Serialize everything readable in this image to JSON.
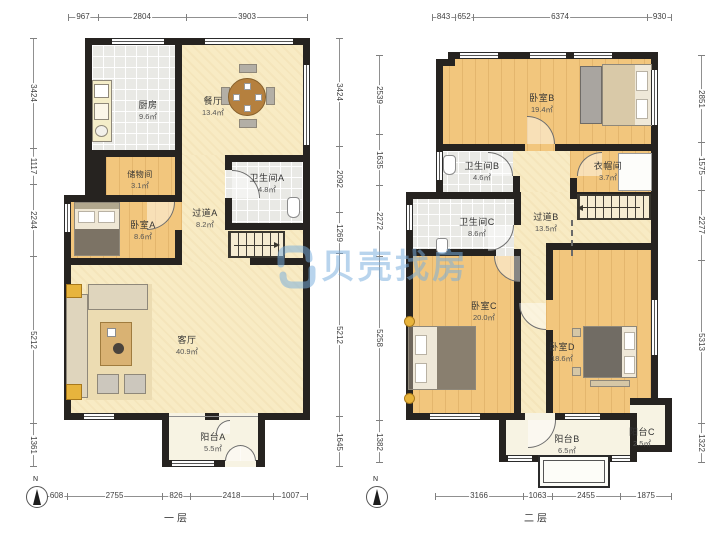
{
  "watermark": {
    "brand": "贝壳找房"
  },
  "floor1": {
    "label": "一层",
    "compass": "N",
    "rooms": {
      "kitchen": {
        "name": "厨房",
        "area": "9.6㎡"
      },
      "dining": {
        "name": "餐厅",
        "area": "13.4㎡"
      },
      "storage": {
        "name": "储物间",
        "area": "3.1㎡"
      },
      "bedroom_a": {
        "name": "卧室A",
        "area": "8.6㎡"
      },
      "hallway_a": {
        "name": "过道A",
        "area": "8.2㎡"
      },
      "bath_a": {
        "name": "卫生间A",
        "area": "4.8㎡"
      },
      "living": {
        "name": "客厅",
        "area": "40.9㎡"
      },
      "balcony_a": {
        "name": "阳台A",
        "area": "5.5㎡"
      }
    },
    "dims": {
      "top": [
        "967",
        "2804",
        "3903"
      ],
      "left": [
        "3424",
        "1117",
        "2244",
        "5212",
        "1361"
      ],
      "right": [
        "3424",
        "2092",
        "1269",
        "5212",
        "1645"
      ],
      "bottom": [
        "608",
        "2755",
        "826",
        "2418",
        "1007"
      ]
    }
  },
  "floor2": {
    "label": "二层",
    "compass": "N",
    "rooms": {
      "bedroom_b": {
        "name": "卧室B",
        "area": "19.4㎡"
      },
      "bath_b": {
        "name": "卫生间B",
        "area": "4.6㎡"
      },
      "cloakroom": {
        "name": "衣帽间",
        "area": "3.7㎡"
      },
      "bath_c": {
        "name": "卫生间C",
        "area": "8.6㎡"
      },
      "hallway_b": {
        "name": "过道B",
        "area": "13.5㎡"
      },
      "bedroom_c": {
        "name": "卧室C",
        "area": "20.0㎡"
      },
      "bedroom_d": {
        "name": "卧室D",
        "area": "18.6㎡"
      },
      "balcony_b": {
        "name": "阳台B",
        "area": "6.5㎡"
      },
      "balcony_c": {
        "name": "阳台C",
        "area": "2.5㎡"
      }
    },
    "dims": {
      "top": [
        "843",
        "652",
        "6374",
        "930"
      ],
      "left": [
        "2539",
        "1635",
        "2272",
        "5258",
        "1382"
      ],
      "right": [
        "2851",
        "1575",
        "2277",
        "5313",
        "1322"
      ],
      "bottom": [
        "3166",
        "1063",
        "2455",
        "1875"
      ]
    }
  }
}
